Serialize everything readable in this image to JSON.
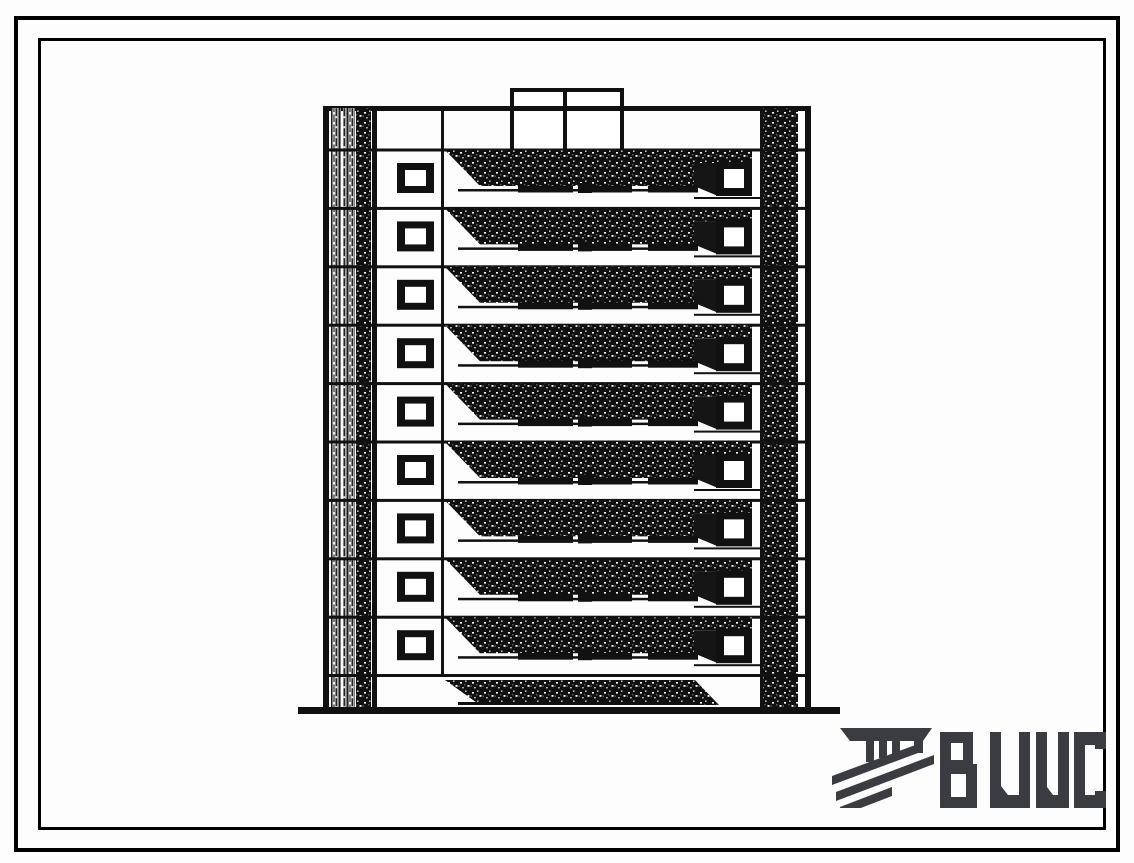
{
  "page": {
    "background": "#ffffff",
    "ink_color": "#111111"
  },
  "frame": {
    "outer_color": "#000000",
    "inner_color": "#000000"
  },
  "drawing": {
    "description": "Scanned end-elevation of a multi-storey panel apartment block with stacked shaded balcony bands",
    "windowed_floors": 9,
    "balcony_bands_total": 10,
    "has_ground_floor_band": true,
    "has_roof_penthouse": true,
    "penthouse_cells": 2,
    "ink_color": "#111111"
  },
  "logo": {
    "text": "ВЦИС",
    "color": "#3b3b42"
  }
}
